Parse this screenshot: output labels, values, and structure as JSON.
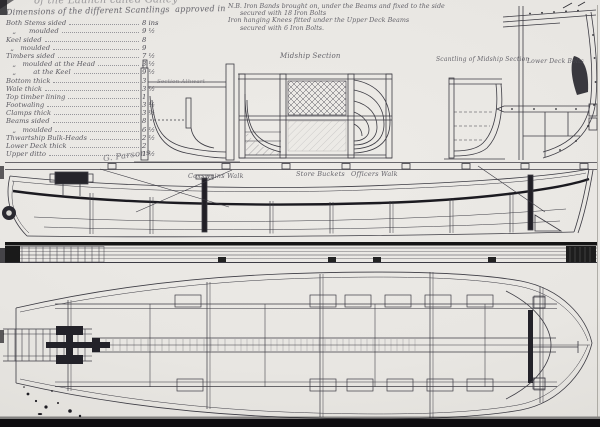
{
  "header": {
    "title_fragment": "of the Launch called Galley"
  },
  "scantlings": {
    "heading": "Dimensions of the different Scantlings  approved in",
    "rows": [
      {
        "label": "Both Stems sided",
        "value": "8 ins"
      },
      {
        "label": "   „      moulded",
        "value": "9 ½"
      },
      {
        "label": "Keel sided",
        "value": "8"
      },
      {
        "label": "  „   moulded",
        "value": "9"
      },
      {
        "label": "Timbers sided",
        "value": "7 ½"
      },
      {
        "label": "   „   moulded at the Head",
        "value": "3 ½"
      },
      {
        "label": "   „        at the Keel",
        "value": "9 ½"
      },
      {
        "label": "Bottom thick",
        "value": "3"
      },
      {
        "label": "Wale thick",
        "value": "3 ½"
      },
      {
        "label": "Top timber lining",
        "value": "1"
      },
      {
        "label": "Footwaling",
        "value": "3 ½"
      },
      {
        "label": "Clamps thick",
        "value": "3 ½"
      },
      {
        "label": "Beams sided",
        "value": "8"
      },
      {
        "label": "   „   moulded",
        "value": "6 ½"
      },
      {
        "label": "Thwartship Bulk-Heads",
        "value": "2 ½"
      },
      {
        "label": "Lower Deck thick",
        "value": "2"
      },
      {
        "label": "Upper ditto",
        "value": "1 ½"
      }
    ],
    "signature": "G. Parsons"
  },
  "nb_note": {
    "line1": "N.B. Iron Bands brought on, under the Beams and fixed to the side",
    "line2": "secured with 18 Iron Bolts",
    "line3": "Iron hanging Knees fitted under the Upper Deck Beams",
    "line4": "secured with 6 Iron Bolts."
  },
  "labels": {
    "midship_section": "Midship Section",
    "scantling_midship": "Scantling of Midship Section",
    "lower_deck": "Lower Deck Bolts",
    "section_athwart": "Section Athwart",
    "coxswains_walk": "Coxswains Walk",
    "store_buckets": "Store Buckets",
    "officers_walk": "Officers Walk"
  }
}
